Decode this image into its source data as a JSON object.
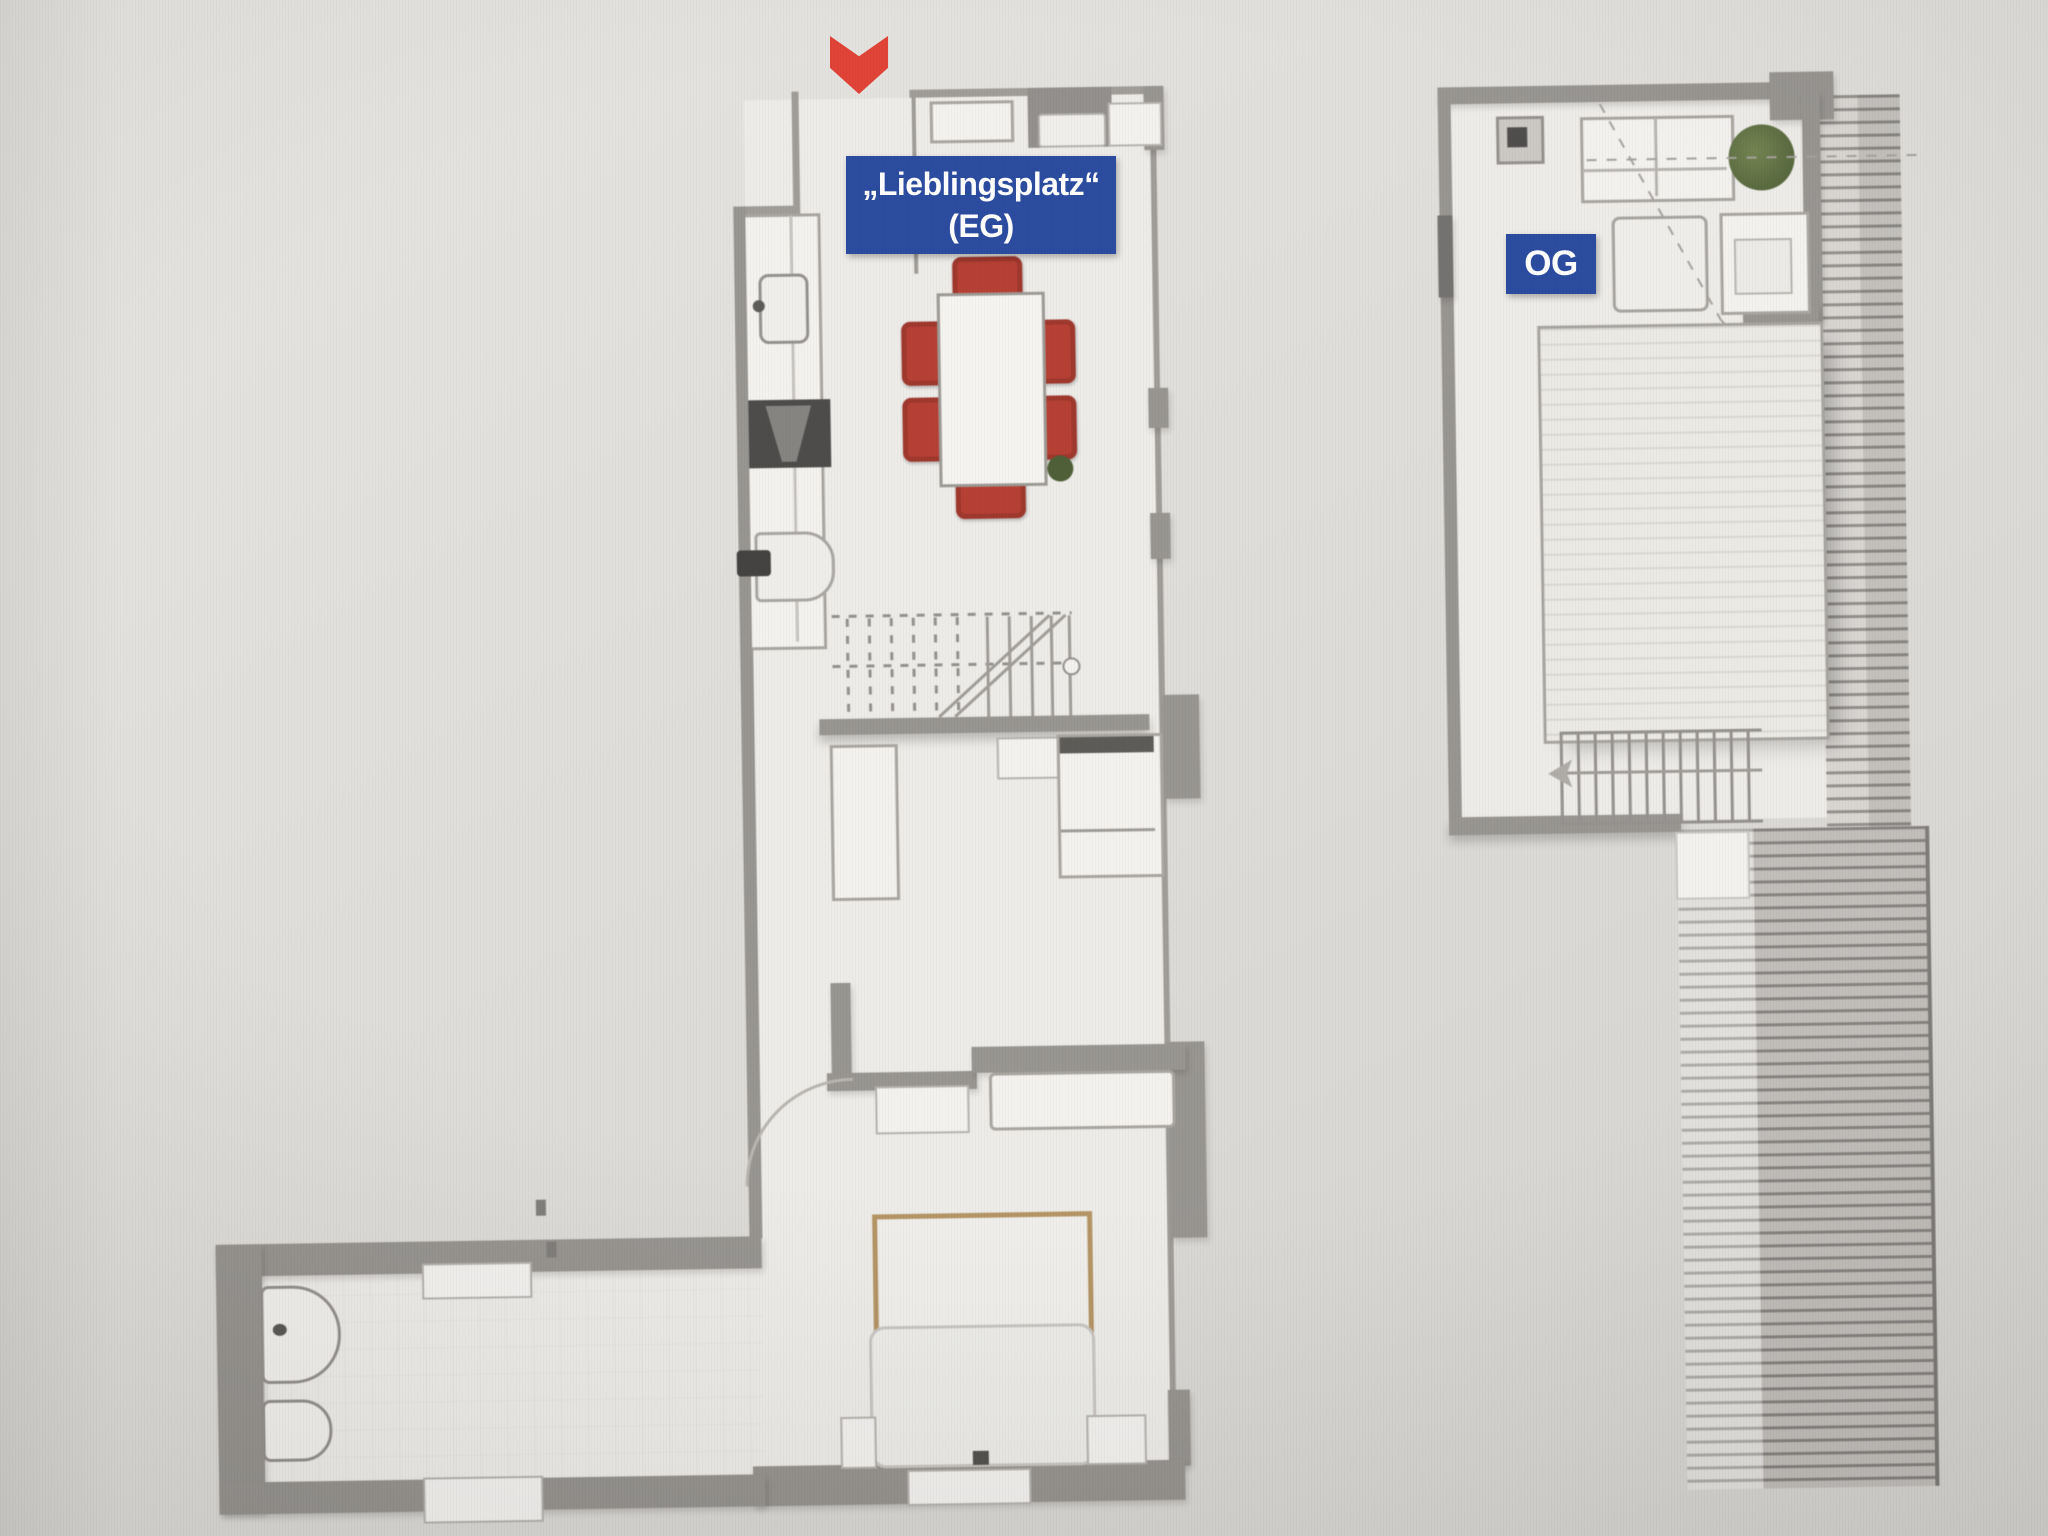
{
  "photo": {
    "type": "floor-plan-photo",
    "background": "#dedcd8"
  },
  "annotations": {
    "eg_label": {
      "line1": "„Lieblingsplatz“",
      "line2": "(EG)"
    },
    "og_label": "OG",
    "entrance_marker": "red-chevron-down"
  },
  "colors": {
    "label_bg": "#21429b",
    "label_text": "#ffffff",
    "arrow_red": "#df392c",
    "chair_red": "#b3362a",
    "plant_green": "#46572e",
    "wall_gray": "#93908c",
    "wall_dark": "#6e6c6a",
    "line_gray": "#9b9894",
    "wood_tan": "#b1905e",
    "floor_light": "#edebe7",
    "deck_line": "#8e8b88"
  },
  "plans": {
    "eg": {
      "symbols": [
        "entrance-arrow",
        "sideboard",
        "tall-cabinet",
        "kitchen-counter",
        "sink",
        "stove",
        "dishwasher",
        "dining-table",
        "dining-chairs-x6",
        "potted-plant",
        "staircase",
        "closet",
        "single-bed",
        "desk",
        "interior-door",
        "door-swing-arc",
        "dresser",
        "double-bed",
        "nightstands",
        "washbasin",
        "toilet",
        "windows"
      ]
    },
    "og": {
      "symbols": [
        "wood-stove",
        "sofa",
        "potted-plant",
        "armchair",
        "coffee-table",
        "roof-slope-dashed-line",
        "gallery-void",
        "staircase-with-direction-arrow",
        "roof-terrace-decking"
      ]
    }
  }
}
